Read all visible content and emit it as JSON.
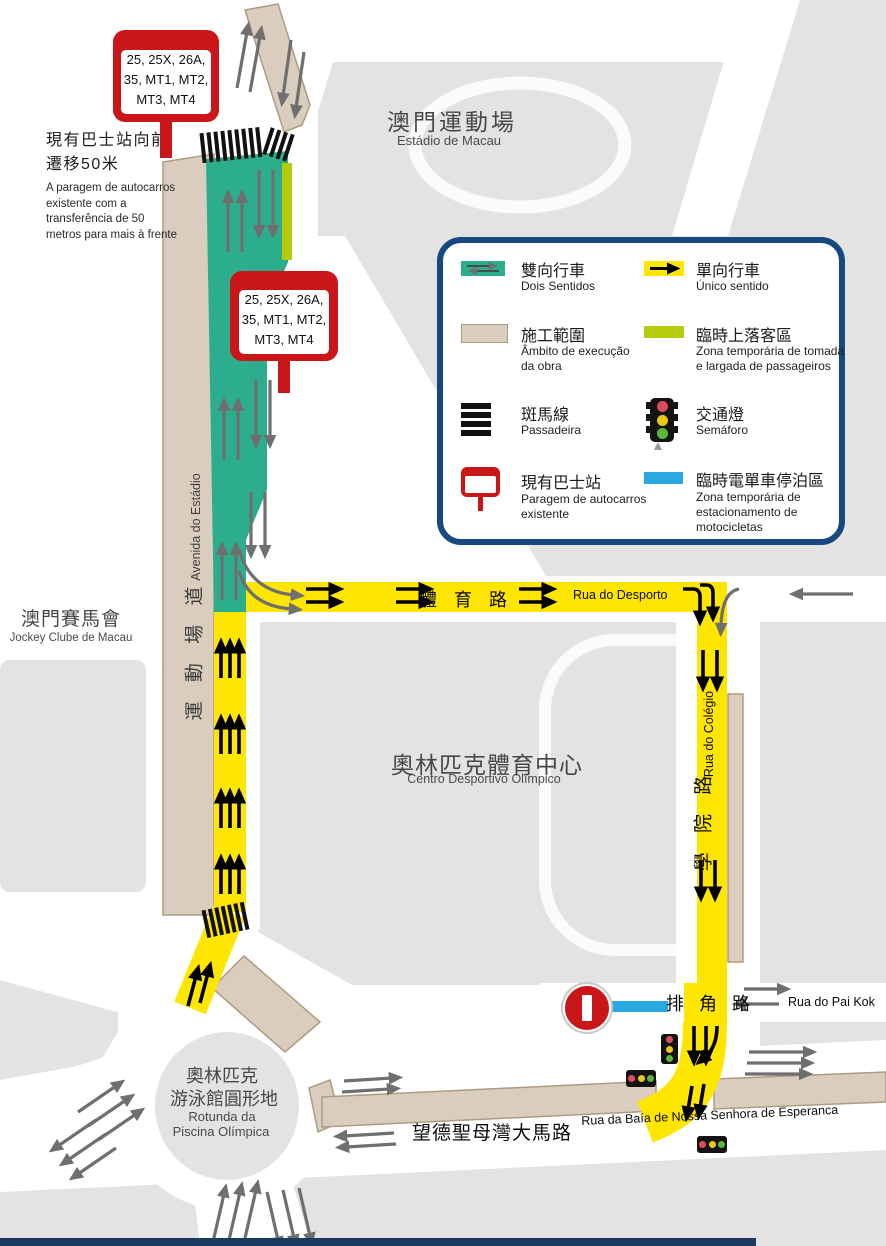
{
  "colors": {
    "two_way_teal": "#2BAD8E",
    "one_way_yellow": "#FFE600",
    "construction_beige": "#DACDBE",
    "passenger_zone_lime": "#B5CB0B",
    "moto_parking_blue": "#2AA9E0",
    "bus_stop_red": "#CB1619",
    "legend_border_navy": "#16497F",
    "block_gray": "#E4E3E1",
    "arrow_gray": "#6F6F6F"
  },
  "places": {
    "stadium": {
      "zh": "澳門運動場",
      "pt": "Estádio de Macau"
    },
    "jockey_club": {
      "zh": "澳門賽馬會",
      "pt": "Jockey Clube de Macau"
    },
    "olympic_center": {
      "zh": "奧林匹克體育中心",
      "pt": "Centro Desportivo Olímpico"
    },
    "roundabout": {
      "zh1": "奧林匹克",
      "zh2": "游泳館圓形地",
      "pt1": "Rotunda da",
      "pt2": "Piscina Olímpica"
    }
  },
  "roads": {
    "desporto": {
      "zh": "體 育 路",
      "pt": "Rua do Desporto"
    },
    "colegio": {
      "zh": "學 院 路",
      "pt": "Rua do Colégio"
    },
    "estadio": {
      "zh": "運 動 場 道",
      "pt": "Avenida do Estádio"
    },
    "pai_kok": {
      "zh": "排 角 路",
      "pt": "Rua do Pai Kok"
    },
    "esperanca": {
      "zh": "望德聖母灣大馬路",
      "pt": "Rua da Baía de Nossa Senhora de Esperanca"
    }
  },
  "notes": {
    "bus_stop_move": {
      "zh1": "現有巴士站向前",
      "zh2": "遷移50米",
      "pt": "A paragem de autocarros existente com a transferência de 50 metros para mais à frente"
    }
  },
  "bus_sign": {
    "line1": "25, 25X, 26A,",
    "line2": "35, MT1, MT2,",
    "line3": "MT3, MT4"
  },
  "legend": {
    "two_way": {
      "zh": "雙向行車",
      "pt": "Dois Sentidos"
    },
    "one_way": {
      "zh": "單向行車",
      "pt": "Único sentido"
    },
    "construction": {
      "zh": "施工範圍",
      "pt": "Âmbito de execução da obra"
    },
    "passenger_zone": {
      "zh": "臨時上落客區",
      "pt": "Zona temporária de tomada e largada de passageiros"
    },
    "crosswalk": {
      "zh": "斑馬線",
      "pt": "Passadeira"
    },
    "traffic_light": {
      "zh": "交通燈",
      "pt": "Semáforo"
    },
    "bus_stop": {
      "zh": "現有巴士站",
      "pt": "Paragem de autocarros existente"
    },
    "moto_parking": {
      "zh": "臨時電單車停泊區",
      "pt": "Zona temporária de estacionamento de motocicletas"
    }
  }
}
